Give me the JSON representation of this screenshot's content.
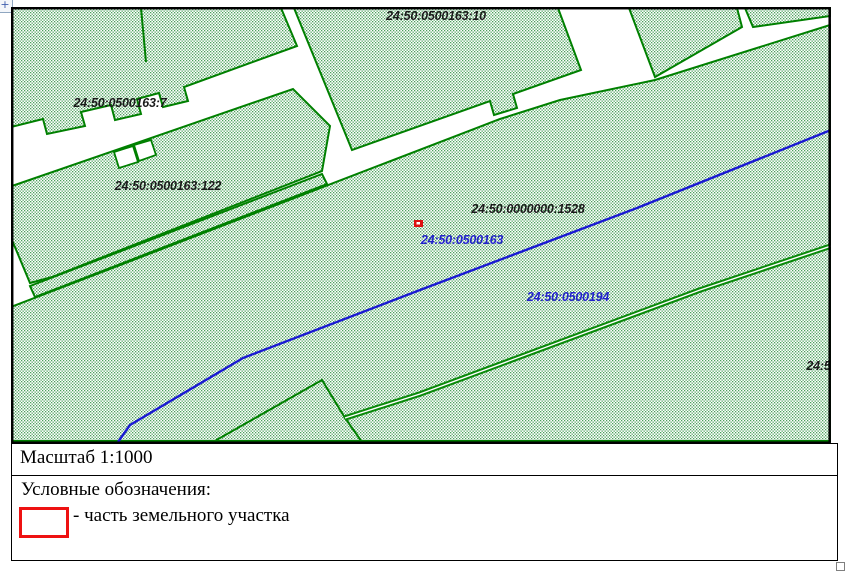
{
  "document": {
    "map": {
      "parcel_labels": [
        {
          "text": "24:50:0500163:10",
          "x": 436,
          "y": 20,
          "color": "#1a1a1a"
        },
        {
          "text": "24:50:0500163:7",
          "x": 120,
          "y": 107,
          "color": "#1a1a1a"
        },
        {
          "text": "24:50:0500163:122",
          "x": 168,
          "y": 190,
          "color": "#1a1a1a"
        },
        {
          "text": "24:50:0000000:1528",
          "x": 528,
          "y": 213,
          "color": "#1a1a1a"
        },
        {
          "text": "24:50:0500163",
          "x": 462,
          "y": 244,
          "color": "#2222cc"
        },
        {
          "text": "24:50:0500194",
          "x": 568,
          "y": 301,
          "color": "#2222cc"
        },
        {
          "text": "24:50:050",
          "x": 834,
          "y": 370,
          "color": "#1a1a1a",
          "anchor": "end"
        }
      ],
      "marker": {
        "x": 414,
        "y": 220,
        "width": 9,
        "height": 7,
        "color": "#dd1111"
      },
      "colors": {
        "parcel_outline": "#008000",
        "quarter_boundary_blue": "#1a1ad2",
        "road_double_line": "#0a8a0a",
        "hatch_dot": "#4aa05a",
        "map_border": "#000000"
      }
    },
    "scale_row": {
      "text": "Масштаб 1:1000"
    },
    "legend": {
      "title": "Условные обозначения:",
      "items": [
        {
          "symbol": "part-of-parcel-rect",
          "symbol_color": "#ee1111",
          "label": "- часть земельного участка"
        }
      ]
    },
    "handles": {
      "move_glyph": "+"
    }
  }
}
